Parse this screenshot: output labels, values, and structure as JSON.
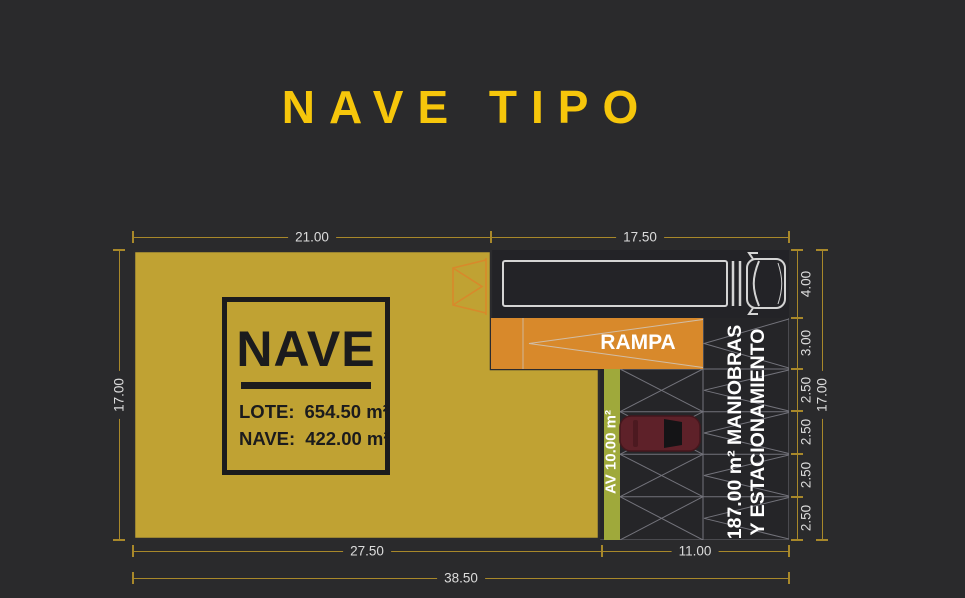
{
  "title": "NAVE TIPO",
  "colors": {
    "background": "#2A2A2C",
    "title_text": "#F6C60B",
    "nave_fill": "#C0A233",
    "rampa_fill": "#D8892B",
    "av_fill": "#9FA93B",
    "dim_line": "#A8882A",
    "dim_text": "#DCDCDC",
    "car_fill": "#5E2129",
    "truck_outline": "#D4D4D4"
  },
  "plan": {
    "nave_box": {
      "title": "NAVE",
      "rows": [
        {
          "label": "LOTE:",
          "value": "654.50 m²"
        },
        {
          "label": "NAVE:",
          "value": "422.00 m²"
        }
      ]
    },
    "zones": {
      "rampa": "RAMPA",
      "av": "AV 10.00 m²",
      "maniobras_line1": "187.00 m² MANIOBRAS",
      "maniobras_line2": "Y ESTACIONAMIENTO"
    }
  },
  "dims": {
    "top": [
      "21.00",
      "17.50"
    ],
    "left_total": "17.00",
    "right": [
      "4.00",
      "3.00",
      "2.50",
      "2.50",
      "2.50",
      "2.50"
    ],
    "right_total": "17.00",
    "bottom": [
      "27.50",
      "11.00"
    ],
    "bottom_total": "38.50"
  }
}
